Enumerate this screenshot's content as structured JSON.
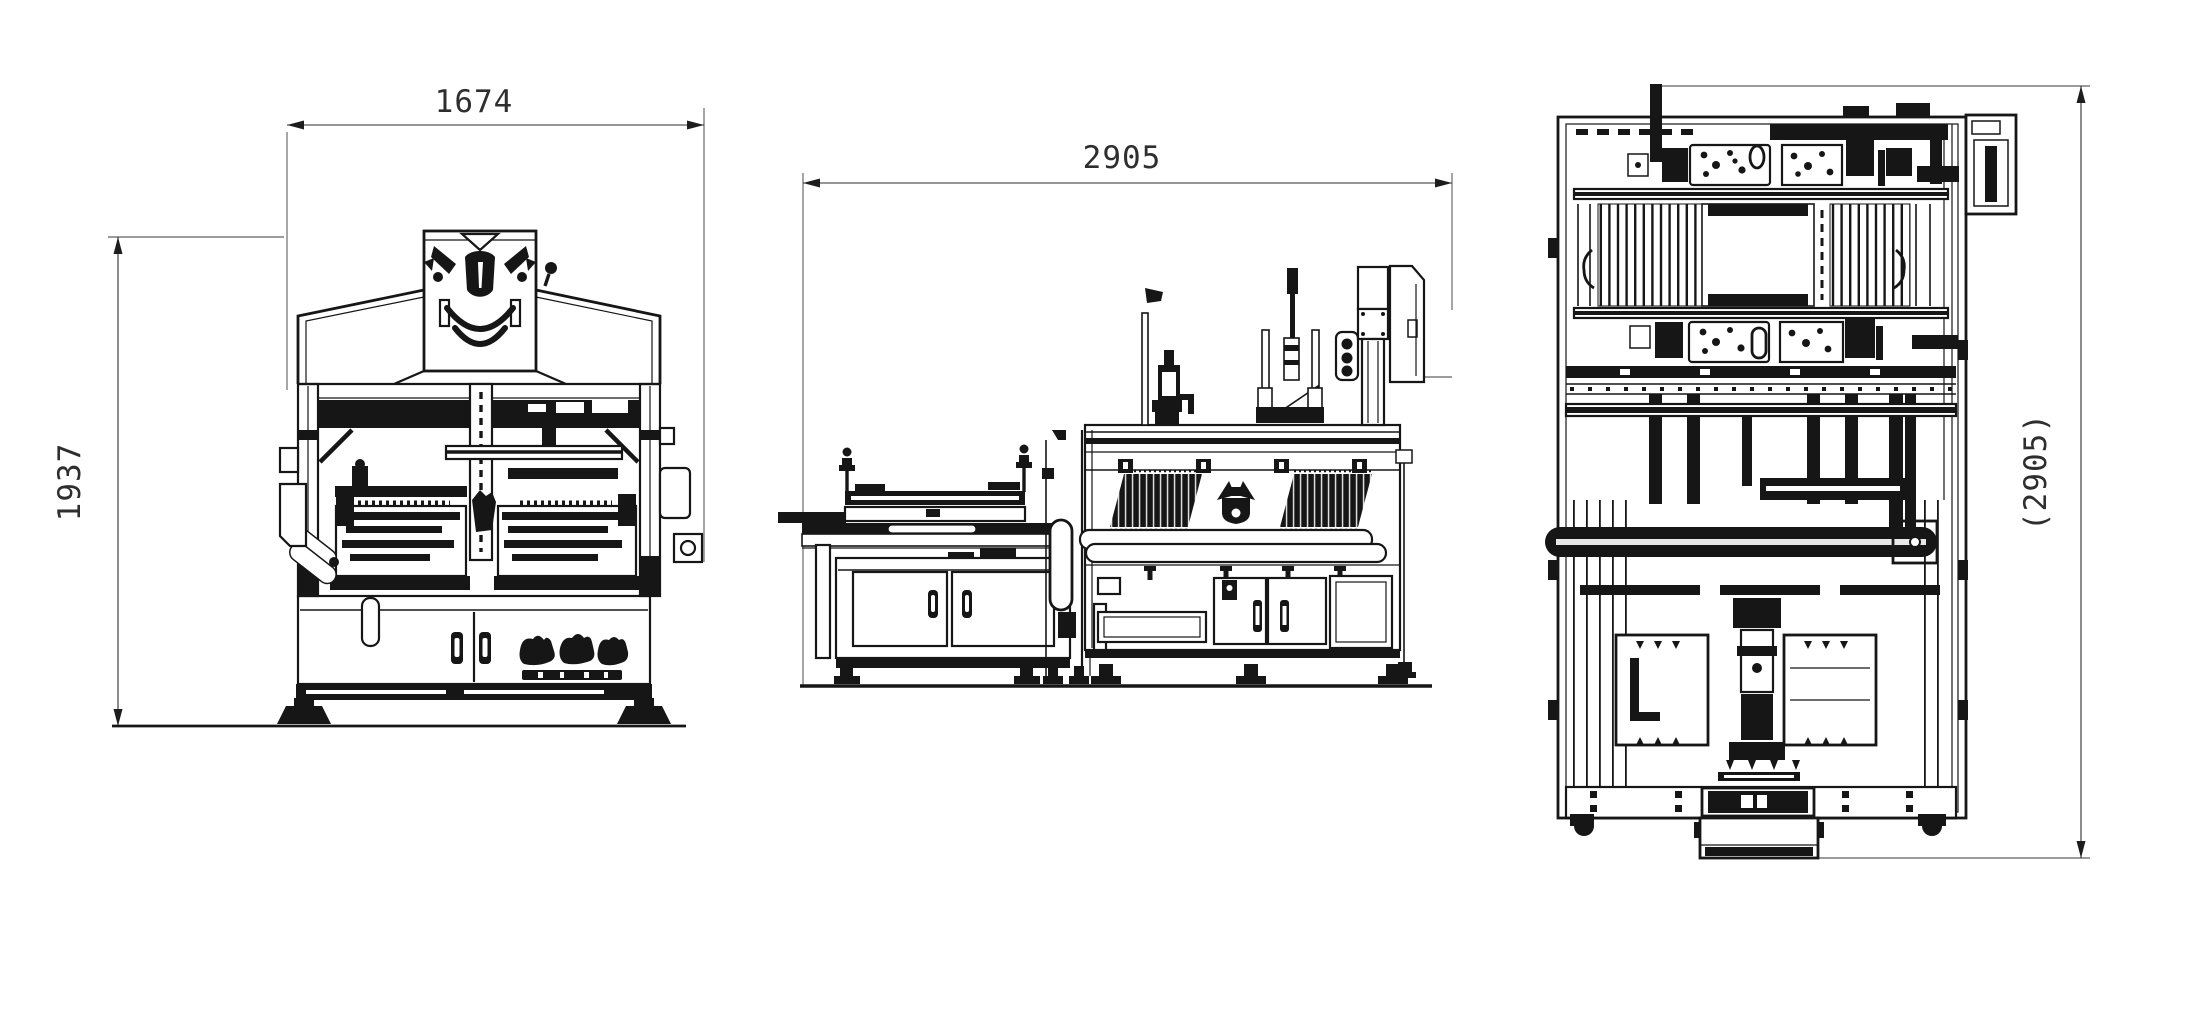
{
  "page": {
    "background": "#ffffff"
  },
  "drawing": {
    "ink_color": "#161616",
    "dim_color": "#2e2e2e",
    "dims": {
      "front_width": "1674",
      "front_height": "1937",
      "side_length": "2905",
      "top_length": "(2905)"
    }
  }
}
